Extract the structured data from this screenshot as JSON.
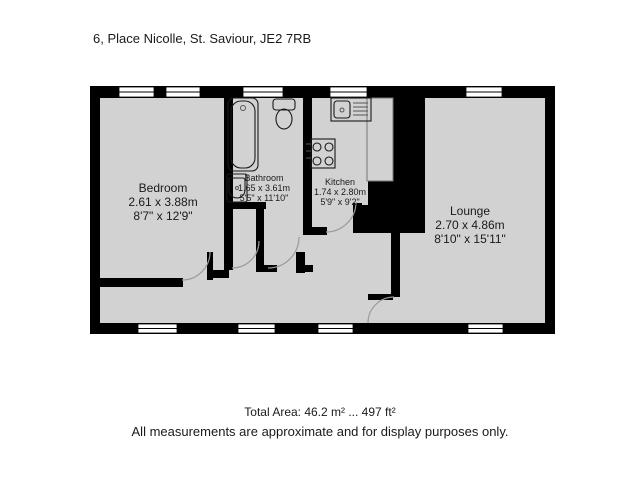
{
  "title": "6, Place Nicolle, St. Saviour, JE2 7RB",
  "rooms": [
    {
      "name": "Bedroom",
      "metric": "2.61 x 3.88m",
      "imperial": "8'7\" x 12'9\""
    },
    {
      "name": "Bathroom",
      "metric": "1.65 x 3.61m",
      "imperial": "5'5\" x 11'10\""
    },
    {
      "name": "Kitchen",
      "metric": "1.74 x 2.80m",
      "imperial": "5'9\" x 9'2\""
    },
    {
      "name": "Lounge",
      "metric": "2.70 x 4.86m",
      "imperial": "8'10\" x 15'11\""
    }
  ],
  "footer": {
    "total_area": "Total Area: 46.2 m² ... 497 ft²",
    "disclaimer": "All measurements are approximate and for display purposes only."
  },
  "colors": {
    "wall": "#000000",
    "floor": "#d2d2d2",
    "background": "#ffffff",
    "text": "#1a1a1a"
  }
}
